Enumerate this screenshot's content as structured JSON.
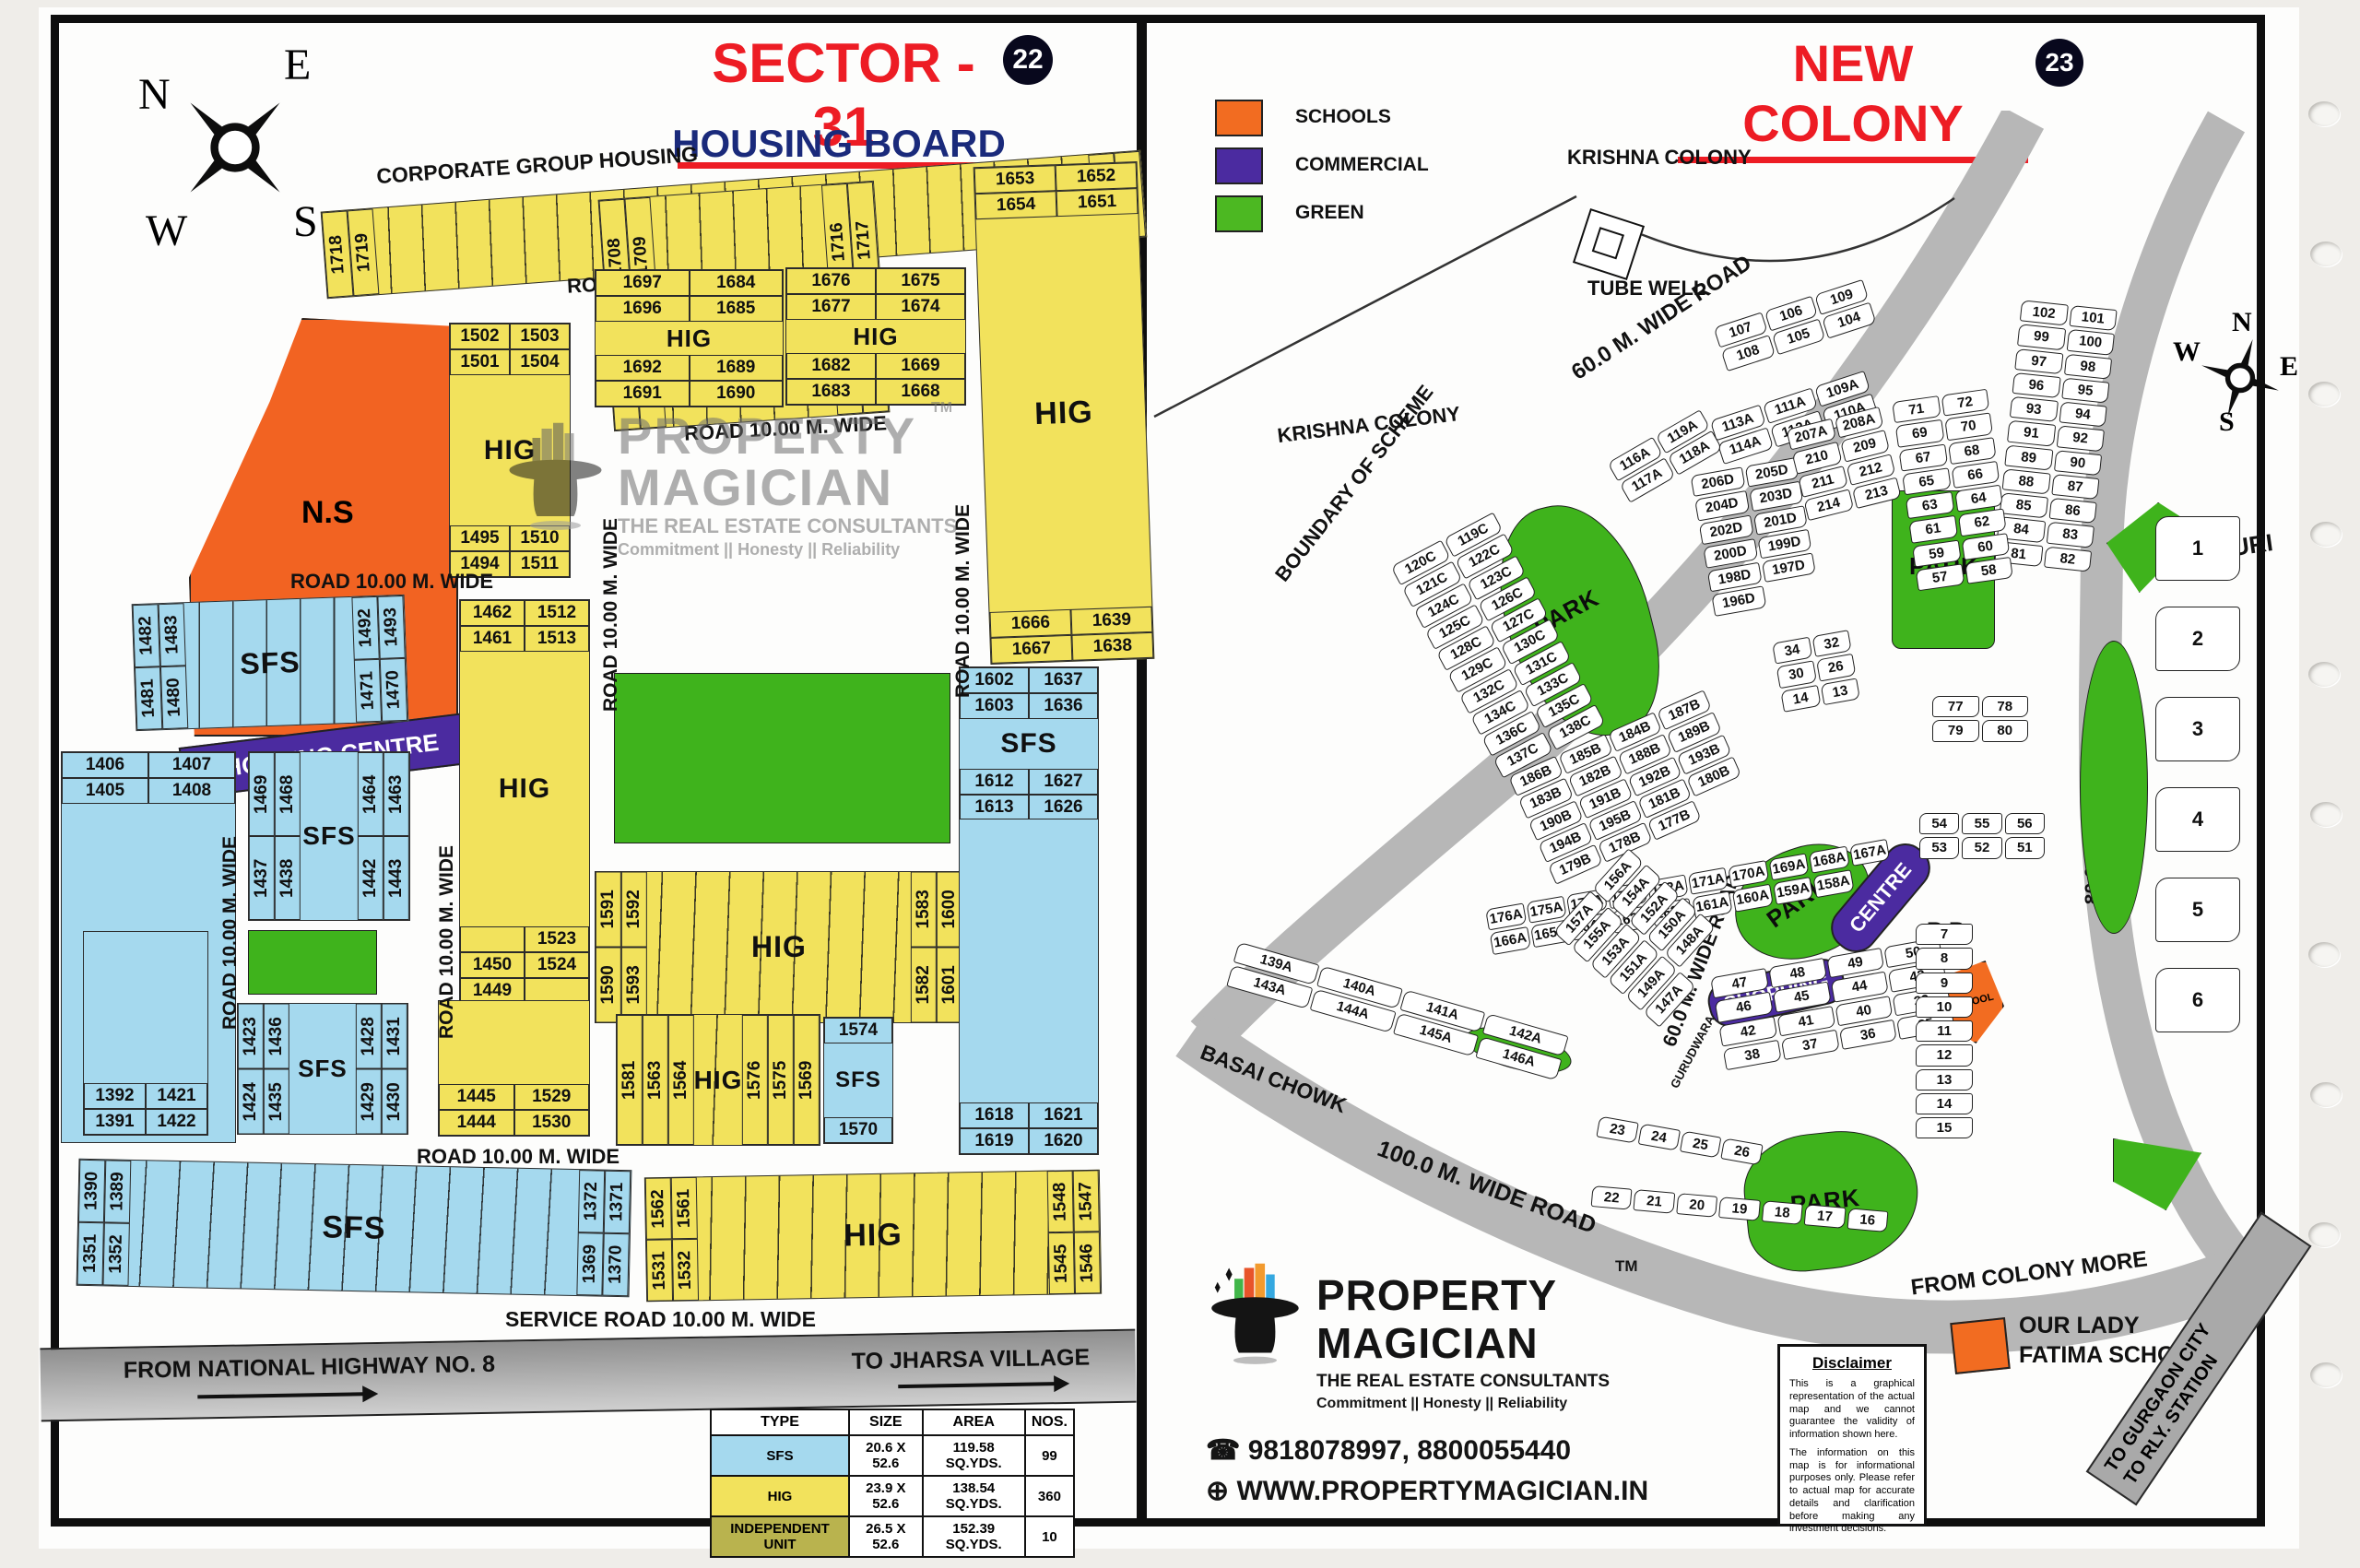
{
  "brand": {
    "name1": "PROPERTY",
    "name2": "MAGICIAN",
    "tm": "TM",
    "tagline": "THE REAL ESTATE CONSULTANTS",
    "motto": "Commitment  ||  Honesty  ||  Reliability",
    "phone": "9818078997, 8800055440",
    "website": "WWW.PROPERTYMAGICIAN.IN",
    "phone_icon": "phone-icon",
    "globe_icon": "globe-icon"
  },
  "left_panel": {
    "badge": "22",
    "title": "SECTOR - 31",
    "subtitle": "HOUSING BOARD",
    "compass": {
      "n": "N",
      "e": "E",
      "s": "S",
      "w": "W"
    },
    "corporate_label": "CORPORATE GROUP HOUSING",
    "road_label": "ROAD 10.00 M. WIDE",
    "service_road_label": "SERVICE ROAD 10.00 M. WIDE",
    "highway_label": "FROM NATIONAL HIGHWAY NO. 8",
    "jharsa_label": "TO JHARSA VILLAGE",
    "ns_label": "N.S",
    "shopping_label": "SHOPPING CENTRE",
    "blocks": {
      "strip_top": {
        "label": "HIG",
        "left": [
          "1718",
          "1719"
        ],
        "right": [
          "1744",
          "1745"
        ]
      },
      "hig_b": {
        "label": "HIG",
        "left": [
          "1708",
          "1709",
          "1707",
          "1706"
        ],
        "right": [
          "1716",
          "1717",
          "1699",
          "1698"
        ]
      },
      "hig_topright": {
        "label": "HIG",
        "top": [
          "1653",
          "1652",
          "1654",
          "1651"
        ],
        "bottom": [
          "1666",
          "1639",
          "1667",
          "1638"
        ]
      },
      "hig_a": {
        "label": "HIG",
        "top": [
          "1502",
          "1503",
          "1501",
          "1504"
        ],
        "bottom": [
          "1495",
          "1510",
          "1494",
          "1511"
        ]
      },
      "hig_mid1": {
        "label": "HIG",
        "top": [
          "1697",
          "1684",
          "1696",
          "1685"
        ],
        "bottom": [
          "1692",
          "1689",
          "1691",
          "1690"
        ]
      },
      "hig_mid2": {
        "label": "HIG",
        "top": [
          "1676",
          "1675",
          "1677",
          "1674"
        ],
        "bottom": [
          "1682",
          "1669",
          "1683",
          "1668"
        ]
      },
      "sfs_upper": {
        "label": "SFS",
        "left": [
          "1482",
          "1483",
          "1481",
          "1480"
        ],
        "right": [
          "1492",
          "1493",
          "1471",
          "1470"
        ]
      },
      "hig_col": {
        "label": "HIG",
        "top": [
          "1462",
          "1512",
          "1461",
          "1513"
        ],
        "bottom": [
          "",
          "1523",
          "1450",
          "1524",
          "1449",
          ""
        ]
      },
      "sfs_left": {
        "label": "SFS",
        "top": [
          "1406",
          "1407",
          "1405",
          "1408"
        ]
      },
      "sfs_mid": {
        "label": "SFS",
        "left": [
          "1469",
          "1468",
          "1437",
          "1438"
        ],
        "right": [
          "1464",
          "1463",
          "1442",
          "1443"
        ]
      },
      "hig_1591": {
        "label": "HIG",
        "left": [
          "1591",
          "1592",
          "1590",
          "1593"
        ],
        "right": [
          "1583",
          "1600",
          "1582",
          "1601"
        ]
      },
      "sfs_right": {
        "label": "SFS",
        "top": [
          "1602",
          "1637",
          "1603",
          "1636"
        ],
        "mid": [
          "1612",
          "1627",
          "1613",
          "1626"
        ],
        "bottom": [
          "1618",
          "1621",
          "1619",
          "1620"
        ]
      },
      "hig_1563": {
        "label": "HIG",
        "left": [
          "1581",
          "1563",
          "1564"
        ],
        "right": [
          "1576",
          "1575",
          "1569"
        ]
      },
      "sfs_1574": {
        "label": "SFS",
        "top": [
          "1574"
        ],
        "bottom": [
          "1570"
        ]
      },
      "hig_1445": {
        "top": [
          "1445",
          "1529",
          "1444",
          "1530"
        ]
      },
      "sfs_1423": {
        "label": "SFS",
        "left": [
          "1423",
          "1436",
          "1424",
          "1435"
        ],
        "right": [
          "1428",
          "1431",
          "1429",
          "1430"
        ]
      },
      "sfs_1392": {
        "top": [
          "1392",
          "1421",
          "1391",
          "1422"
        ]
      },
      "sfs_strip_bottom": {
        "label": "SFS",
        "left": [
          "1390",
          "1389",
          "1351",
          "1352"
        ],
        "right": [
          "1372",
          "1371",
          "1369",
          "1370"
        ]
      },
      "hig_strip_bottom": {
        "label": "HIG",
        "left": [
          "1562",
          "1561",
          "1531",
          "1532"
        ],
        "right": [
          "1548",
          "1547",
          "1545",
          "1546"
        ]
      }
    },
    "table": {
      "headers": [
        "TYPE",
        "SIZE",
        "AREA",
        "NOS."
      ],
      "rows": [
        [
          "SFS",
          "20.6 X 52.6",
          "119.58 SQ.YDS.",
          "99"
        ],
        [
          "HIG",
          "23.9 X 52.6",
          "138.54 SQ.YDS.",
          "360"
        ],
        [
          "INDEPENDENT UNIT",
          "26.5 X 52.6",
          "152.39 SQ.YDS.",
          "10"
        ]
      ],
      "row_colors": [
        "#A5D9EE",
        "#F2E25C",
        "#b9b34e"
      ]
    }
  },
  "right_panel": {
    "badge": "23",
    "title": "NEW COLONY",
    "compass": {
      "n": "N",
      "e": "E",
      "s": "S",
      "w": "W"
    },
    "legend": [
      {
        "label": "SCHOOLS",
        "color": "#F26C21"
      },
      {
        "label": "COMMERCIAL",
        "color": "#4B2BA0"
      },
      {
        "label": "GREEN",
        "color": "#4CB822"
      }
    ],
    "labels": {
      "krishna": "KRISHNA COLONY",
      "tube_well": "TUBE WELL",
      "boundary": "BOUNDARY OF SCHEME",
      "shiv_puri": "SHIV PURI",
      "basai": "BASAI CHOWK",
      "road60": "60.0 M. WIDE ROAD",
      "road100": "100.0 M. WIDE ROAD",
      "road80": "80.0 M. WIDE ROAD",
      "colony_more": "FROM COLONY MORE",
      "gurgaon": "TO GURGAON CITY",
      "rly": "TO RLY. STATION",
      "gurudwara": "GURUDWARA",
      "rb": "R.B",
      "school": "SCHOOL",
      "park": "PARK",
      "shopping": "SHOPPING",
      "centre": "CENTRE",
      "fatima1": "OUR LADY",
      "fatima2": "FATIMA SCHOOL"
    },
    "clusters": {
      "top_pairs": [
        "107",
        "106",
        "109",
        "108",
        "105",
        "104"
      ],
      "road_right": [
        "102",
        "101",
        "99",
        "100",
        "97",
        "98",
        "96",
        "95",
        "93",
        "94",
        "91",
        "92",
        "89",
        "90",
        "88",
        "87",
        "85",
        "86",
        "84",
        "83",
        "81",
        "82"
      ],
      "a_upper": [
        "113A",
        "111A",
        "109A",
        "114A",
        "112A",
        "110A"
      ],
      "a_left": [
        "116A",
        "119A",
        "117A",
        "118A"
      ],
      "c_series": [
        "120C",
        "119C",
        "121C",
        "122C",
        "124C",
        "123C",
        "125C",
        "126C",
        "128C",
        "127C",
        "129C",
        "130C",
        "132C",
        "131C",
        "134C",
        "133C",
        "136C",
        "135C",
        "137C",
        "138C"
      ],
      "inner_col": [
        "71",
        "72",
        "69",
        "70",
        "67",
        "68",
        "65",
        "66",
        "63",
        "64",
        "61",
        "62",
        "59",
        "60",
        "57",
        "58"
      ],
      "seventies": [
        "77",
        "78",
        "79",
        "80"
      ],
      "d_series": [
        "206D",
        "205D",
        "204D",
        "203D",
        "202D",
        "201D",
        "200D",
        "199D",
        "198D",
        "197D",
        "196D"
      ],
      "a207": [
        "207A",
        "208A",
        "210",
        "209",
        "211",
        "212",
        "214",
        "213"
      ],
      "mid_small": [
        "34",
        "32",
        "30",
        "26",
        "14",
        "13"
      ],
      "b_series": [
        "186B",
        "185B",
        "184B",
        "187B",
        "183B",
        "182B",
        "188B",
        "189B",
        "190B",
        "191B",
        "192B",
        "193B",
        "194B",
        "195B",
        "181B",
        "180B",
        "179B",
        "178B",
        "177B"
      ],
      "a_mid": [
        "176A",
        "175A",
        "174A",
        "173A",
        "172A",
        "171A",
        "170A",
        "169A",
        "168A",
        "167A",
        "166A",
        "165A",
        "164A",
        "163A",
        "162A",
        "161A",
        "160A",
        "159A",
        "158A"
      ],
      "a_bottom": [
        "139A",
        "140A",
        "141A",
        "142A",
        "143A",
        "144A",
        "145A",
        "146A"
      ],
      "a_right": [
        "157A",
        "156A",
        "155A",
        "154A",
        "153A",
        "152A",
        "151A",
        "150A",
        "149A",
        "148A",
        "147A"
      ],
      "center_lower": [
        "47",
        "48",
        "49",
        "50",
        "46",
        "45",
        "44",
        "43",
        "42",
        "41",
        "40",
        "39",
        "38",
        "37",
        "36",
        "35"
      ],
      "fifties": [
        "54",
        "55",
        "56",
        "53",
        "52",
        "51"
      ],
      "twenties": [
        "23",
        "24",
        "25",
        "26"
      ],
      "bottom_row": [
        "22",
        "21",
        "20",
        "19",
        "18",
        "17",
        "16"
      ],
      "right_col": [
        "7",
        "8",
        "9",
        "10",
        "11",
        "12",
        "13",
        "14",
        "15"
      ],
      "far_right": [
        "1",
        "2",
        "3",
        "4",
        "5",
        "6"
      ]
    },
    "disclaimer": {
      "title": "Disclaimer",
      "p1": "This is a graphical representation of the actual map and we cannot guarantee the validity of information shown here.",
      "p2": "The information on this map is for informational purposes only. Please refer to actual map for accurate details and clarification before making any investment decisions."
    }
  }
}
